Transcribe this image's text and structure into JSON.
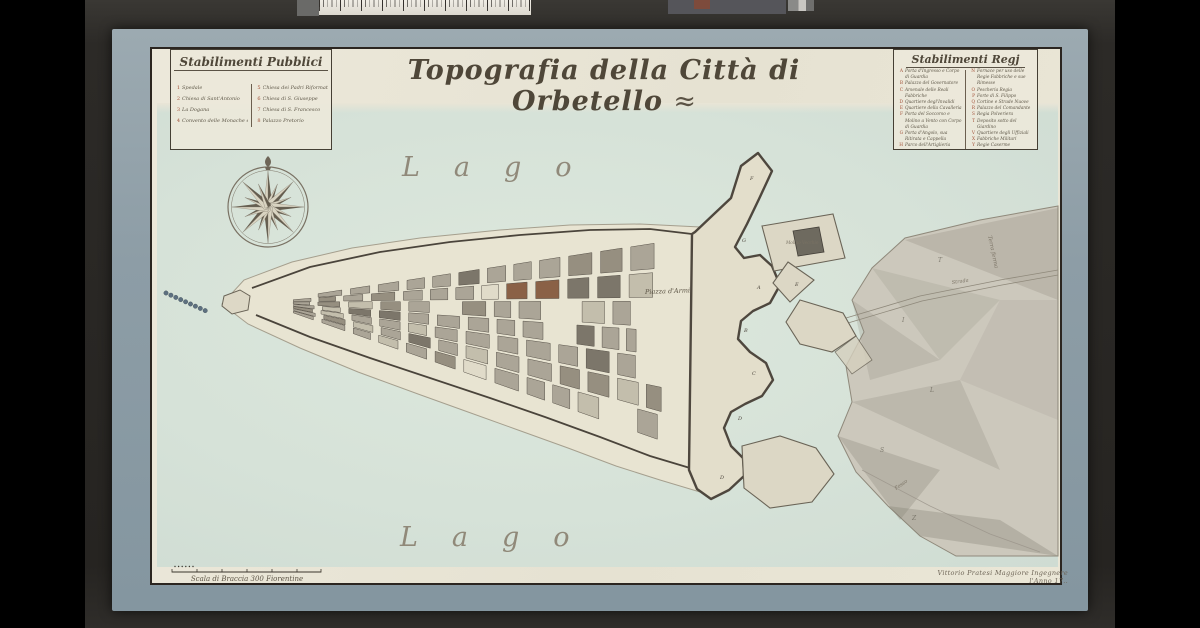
{
  "artwork": {
    "title": "Topografia della Città di Orbetello",
    "title_flourish": "≈"
  },
  "legend_public": {
    "header": "Stabilimenti Pubblici",
    "col1": [
      {
        "n": "1",
        "t": "Spedale"
      },
      {
        "n": "2",
        "t": "Chiesa di Sant'Antonio"
      },
      {
        "n": "3",
        "t": "La Dogana"
      },
      {
        "n": "4",
        "t": "Convento delle Monache e sua Chiesa"
      }
    ],
    "col2": [
      {
        "n": "5",
        "t": "Chiesa dei Padri Riformati del Monte Argentario"
      },
      {
        "n": "6",
        "t": "Chiesa di S. Giuseppe"
      },
      {
        "n": "7",
        "t": "Chiesa di S. Francesco"
      },
      {
        "n": "8",
        "t": "Palazzo Pretorio"
      }
    ]
  },
  "legend_royal": {
    "header": "Stabilimenti Regj",
    "col1": [
      {
        "n": "A",
        "t": "Porta d'Ingresso e Corpo di Guardia"
      },
      {
        "n": "B",
        "t": "Palazzo del Governatore"
      },
      {
        "n": "C",
        "t": "Arsenale delle Reali Fabbriche"
      },
      {
        "n": "D",
        "t": "Quartiere degl'Invalidi"
      },
      {
        "n": "E",
        "t": "Quartiere della Cavalleria"
      },
      {
        "n": "F",
        "t": "Porta del Soccorso e Molino a Vento con Corpo di Guardia"
      },
      {
        "n": "G",
        "t": "Porta d'Angolo, sua Ritirata e Cappella"
      },
      {
        "n": "H",
        "t": "Parco dell'Artiglieria"
      },
      {
        "n": "I",
        "t": "Polveriera"
      },
      {
        "n": "K",
        "t": "Scuderie Militari"
      },
      {
        "n": "L",
        "t": "Magazzino da grani ed Acquedotto degli Uffiziali d'Artiglieria"
      },
      {
        "n": "M",
        "t": "Cisterna"
      }
    ],
    "col2": [
      {
        "n": "N",
        "t": "Fornace per uso delle Regie Fabbriche e sue Rimesse"
      },
      {
        "n": "O",
        "t": "Pescheria Regia"
      },
      {
        "n": "P",
        "t": "Forte di S. Filippo"
      },
      {
        "n": "Q",
        "t": "Cortine e Strade Nuove"
      },
      {
        "n": "R",
        "t": "Palazzo del Comandante"
      },
      {
        "n": "S",
        "t": "Regia Polveriera"
      },
      {
        "n": "T",
        "t": "Deposito sotto del Giardino"
      },
      {
        "n": "V",
        "t": "Quartiere degli Uffiziali"
      },
      {
        "n": "X",
        "t": "Fabbriche Militari"
      },
      {
        "n": "Y",
        "t": "Regie Caserme"
      },
      {
        "n": "Z",
        "t": "Porta di Mare, Corpo di Guardia e Ponte"
      }
    ]
  },
  "map_labels": {
    "lago_top": "Lago",
    "lago_bottom": "Lago",
    "piazza": "Piazza d'Armi",
    "molino": "Molino Vecchio",
    "strada": "Strada",
    "fosso": "Fosso",
    "terraferma": "Terra ferma",
    "bastions": [
      "F",
      "G",
      "A",
      "B",
      "C",
      "D",
      "D",
      "E"
    ],
    "terrain": [
      "T",
      "I",
      "L",
      "S",
      "Z"
    ]
  },
  "scale_bar": {
    "label": "Scala di Braccia 300 Fiorentine"
  },
  "credit": {
    "text": "Vittorio Pratesi Maggiore Ingegnere l'Anno 17.."
  },
  "colors": {
    "lagoon": "#d7e3d9",
    "paper": "#ece8da",
    "mat": "#93a3aa",
    "ink": "#4f4739",
    "red_ink": "#a14f35"
  }
}
